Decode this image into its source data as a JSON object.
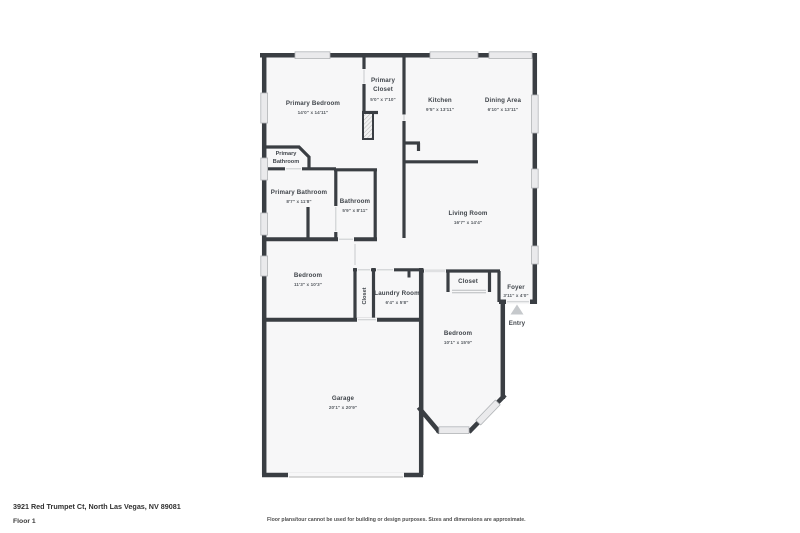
{
  "floorplan": {
    "wall_color": "#3a3e43",
    "room_fill": "#f7f7f8",
    "window_fill": "#eaeaec",
    "rooms": {
      "primary_bedroom": {
        "name": "Primary Bedroom",
        "dims": "14'0\" x 14'11\""
      },
      "primary_closet": {
        "line1": "Primary",
        "line2": "Closet",
        "dims": "5'0\" x 7'10\""
      },
      "kitchen": {
        "name": "Kitchen",
        "dims": "9'5\" x 13'11\""
      },
      "dining_area": {
        "name": "Dining Area",
        "dims": "6'10\" x 13'11\""
      },
      "primary_bathroom_wc": {
        "line1": "Primary",
        "line2": "Bathroom"
      },
      "primary_bathroom": {
        "name": "Primary Bathroom",
        "dims": "8'7\" x 11'8\""
      },
      "bathroom": {
        "name": "Bathroom",
        "dims": "5'9\" x 8'11\""
      },
      "living_room": {
        "name": "Living Room",
        "dims": "16'7\" x 14'4\""
      },
      "bedroom_small": {
        "name": "Bedroom",
        "dims": "11'3\" x 10'3\""
      },
      "hall_closet": {
        "name": "Closet"
      },
      "laundry_room": {
        "name": "Laundry Room",
        "dims": "6'4\" x 5'8\""
      },
      "bedroom_closet": {
        "name": "Closet"
      },
      "foyer": {
        "name": "Foyer",
        "dims": "3'11\" x 4'0\""
      },
      "entry": {
        "name": "Entry"
      },
      "bedroom_front": {
        "name": "Bedroom",
        "dims": "10'1\" x 15'9\""
      },
      "garage": {
        "name": "Garage",
        "dims": "20'1\" x 20'9\""
      }
    }
  },
  "footer": {
    "address": "3921 Red Trumpet Ct, North Las Vegas, NV 89081",
    "floor_label": "Floor 1",
    "disclaimer": "Floor plans/tour cannot be used for building or design purposes. Sizes and dimensions are approximate."
  }
}
